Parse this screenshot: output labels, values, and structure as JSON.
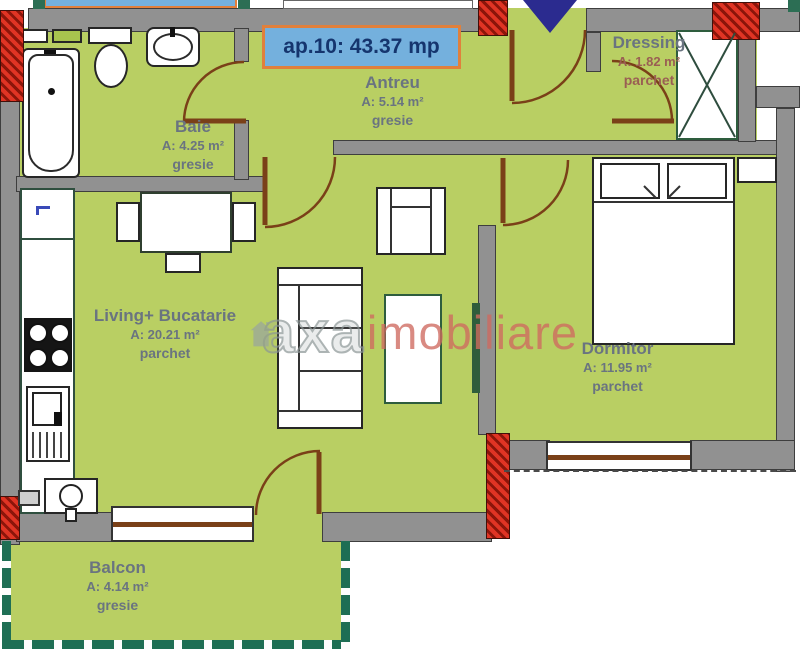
{
  "title": {
    "text": "ap.10: 43.37 mp"
  },
  "rooms": [
    {
      "id": "baie",
      "name": "Baie",
      "area": "A: 4.25 m²",
      "floor": "gresie"
    },
    {
      "id": "antreu",
      "name": "Antreu",
      "area": "A: 5.14 m²",
      "floor": "gresie"
    },
    {
      "id": "dressing",
      "name": "Dressing",
      "area": "A: 1.82 m²",
      "floor": "parchet"
    },
    {
      "id": "living",
      "name": "Living+ Bucatarie",
      "area": "A: 20.21 m²",
      "floor": "parchet"
    },
    {
      "id": "dormitor",
      "name": "Dormitor",
      "area": "A: 11.95 m²",
      "floor": "parchet"
    },
    {
      "id": "balcon",
      "name": "Balcon",
      "area": "A: 4.14 m²",
      "floor": "gresie"
    }
  ],
  "watermark": {
    "brand_first": "axa",
    "brand_second": "imobiliare"
  },
  "symbols": [
    "entrance-arrow",
    "door-swing-arc",
    "window-double-line",
    "wardrobe-x-box",
    "bathtub",
    "toilet",
    "sink",
    "kitchen-counter",
    "kitchen-tap",
    "stove",
    "washing-machine",
    "boiler",
    "dining-table",
    "chair",
    "sofa",
    "coffee-table",
    "armchair",
    "bed",
    "pillow",
    "nightstand",
    "radiator",
    "balcony-railing"
  ],
  "colors": {
    "floor_green": "#b9cf63",
    "wall_gray": "#919191",
    "brick_red": "#e03424",
    "accent_teal": "#2c6e54",
    "label_box_blue": "#74b0dd",
    "label_box_border_orange": "#e0803c",
    "title_text_navy": "#15356e",
    "door_brown": "#7a4018",
    "entrance_marker_navy": "#2b2b8f",
    "watermark_red": "#cf6a60",
    "watermark_gray": "#97a1a1",
    "room_label_gray": "#6a7480"
  }
}
